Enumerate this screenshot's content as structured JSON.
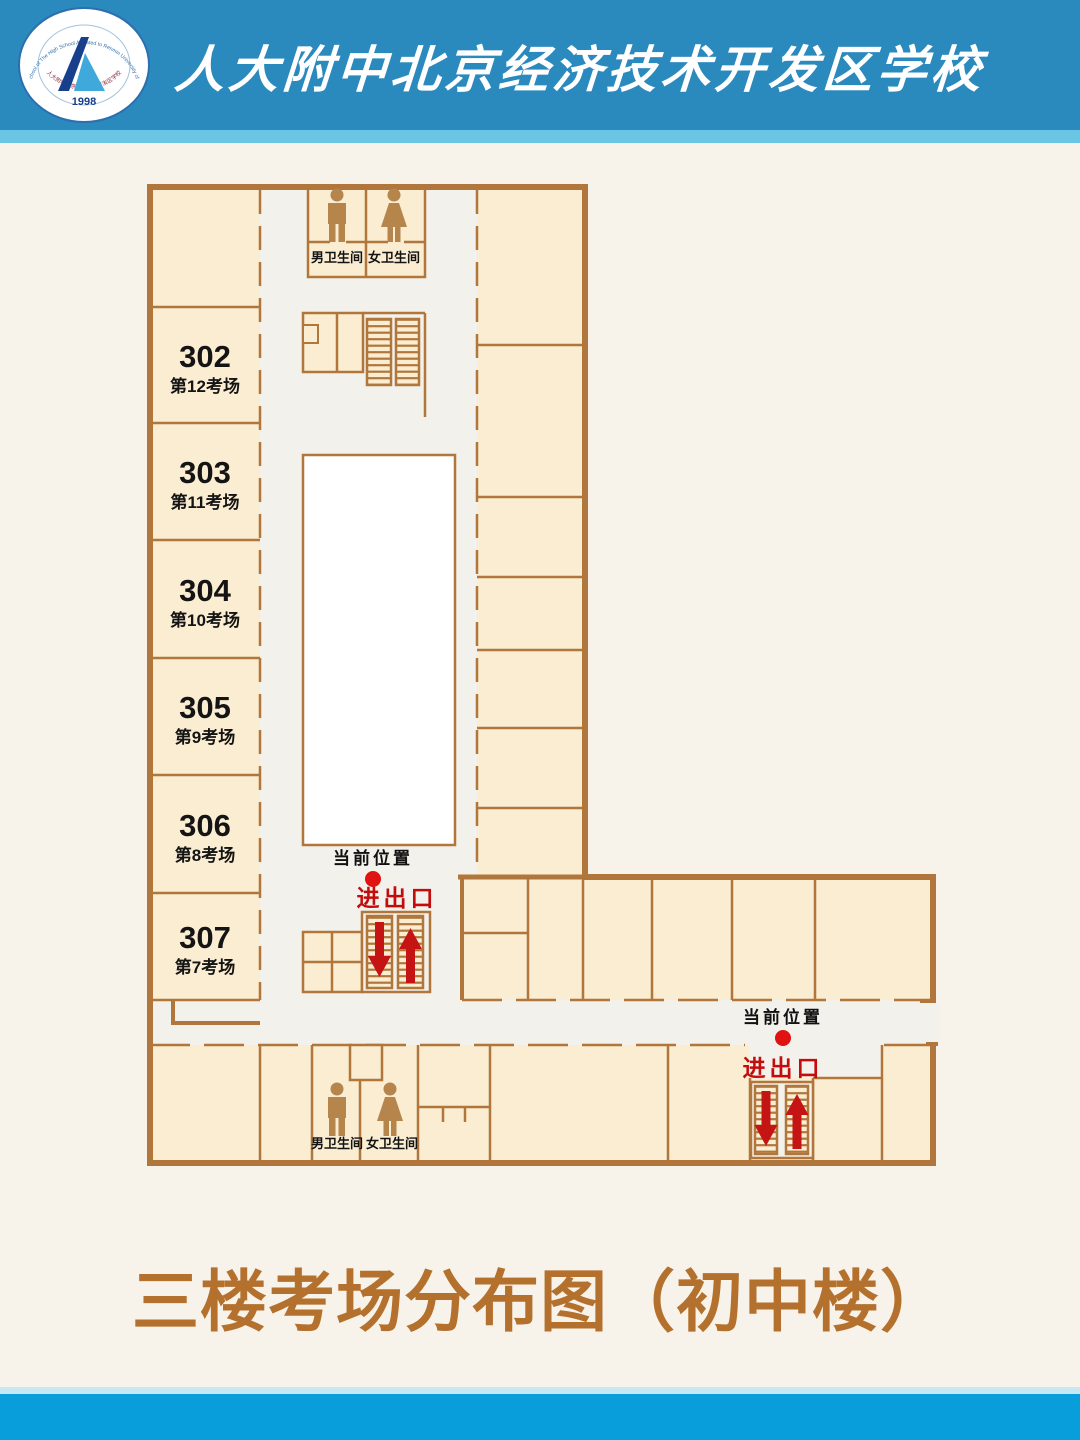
{
  "header": {
    "school_name": "人大附中北京经济技术开发区学校",
    "logo": {
      "year": "1998",
      "ring_text_top": "BDA School of The High School Affiliated to Renmin University of China",
      "ring_text_bottom": "人大附中北京经济技术开发区学校"
    }
  },
  "plan": {
    "left_rooms": [
      {
        "number": "302",
        "exam_label": "第12考场"
      },
      {
        "number": "303",
        "exam_label": "第11考场"
      },
      {
        "number": "304",
        "exam_label": "第10考场"
      },
      {
        "number": "305",
        "exam_label": "第9考场"
      },
      {
        "number": "306",
        "exam_label": "第8考场"
      },
      {
        "number": "307",
        "exam_label": "第7考场"
      }
    ],
    "restroom_male": "男卫生间",
    "restroom_female": "女卫生间",
    "current_location_label": "当前位置",
    "entrance_exit_label": "进出口"
  },
  "footer_title": "三楼考场分布图（初中楼）",
  "colors": {
    "header_blue": "#2b8abd",
    "header_accent": "#6ac4e4",
    "footer_blue": "#089ddb",
    "wall_brown": "#b0763b",
    "room_fill": "#faedd2",
    "title_brown": "#b4712e",
    "marker_red": "#c30d0d"
  }
}
